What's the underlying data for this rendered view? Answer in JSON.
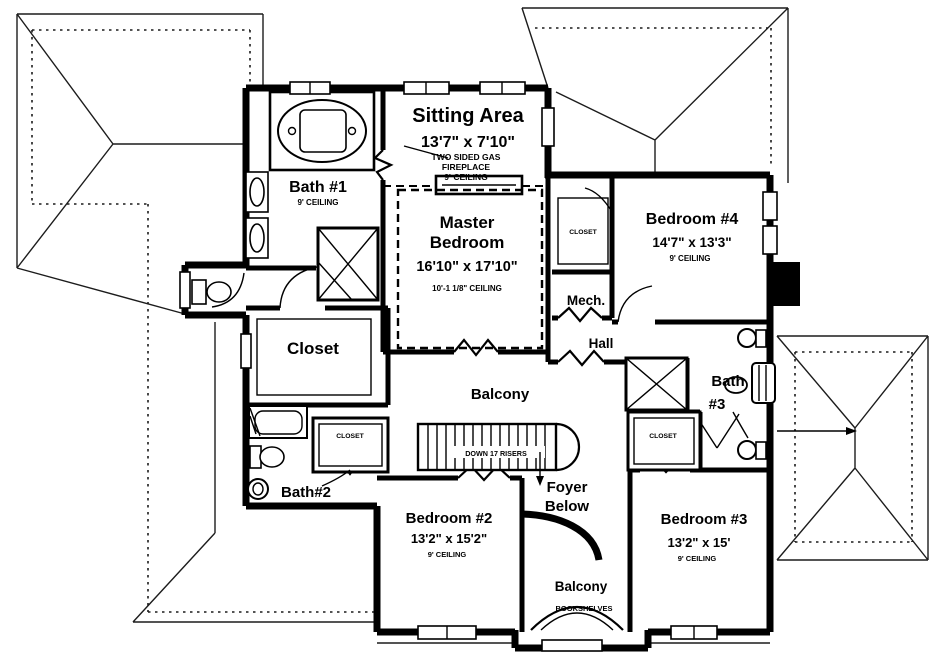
{
  "plan": {
    "type": "second-floor-plan",
    "rooms": {
      "sitting": {
        "name": "Sitting Area",
        "dims": "13'7\" x 7'10\"",
        "note_line1": "TWO SIDED GAS",
        "note_line2": "FIREPLACE",
        "note_line3": "9' CEILING"
      },
      "bath1": {
        "name": "Bath #1",
        "ceiling": "9' CEILING"
      },
      "master": {
        "name_line1": "Master",
        "name_line2": "Bedroom",
        "dims": "16'10\" x 17'10\"",
        "ceiling": "10'-1 1/8\" CEILING"
      },
      "bedroom4": {
        "name": "Bedroom #4",
        "dims": "14'7\" x 13'3\"",
        "ceiling": "9' CEILING"
      },
      "closet_bedroom4": {
        "name": "CLOSET"
      },
      "mech": {
        "name": "Mech."
      },
      "hall": {
        "name": "Hall"
      },
      "master_closet": {
        "name": "Closet"
      },
      "balcony": {
        "name": "Balcony"
      },
      "stairs": {
        "note": "DOWN 17 RISERS"
      },
      "foyer": {
        "name_line1": "Foyer",
        "name_line2": "Below"
      },
      "bath2": {
        "name": "Bath#2"
      },
      "closet_bedroom2": {
        "name": "CLOSET"
      },
      "bedroom2": {
        "name": "Bedroom #2",
        "dims": "13'2\" x 15'2\"",
        "ceiling": "9' CEILING"
      },
      "bedroom3": {
        "name": "Bedroom #3",
        "dims": "13'2\" x 15'",
        "ceiling": "9' CEILING"
      },
      "closet_bedroom3": {
        "name": "CLOSET"
      },
      "bath3": {
        "name_line1": "Bath",
        "name_line2": "#3"
      },
      "balcony_lower": {
        "name": "Balcony",
        "note": "BOOKSHELVES"
      }
    },
    "colors": {
      "ink": "#000000",
      "paper": "#ffffff"
    }
  }
}
